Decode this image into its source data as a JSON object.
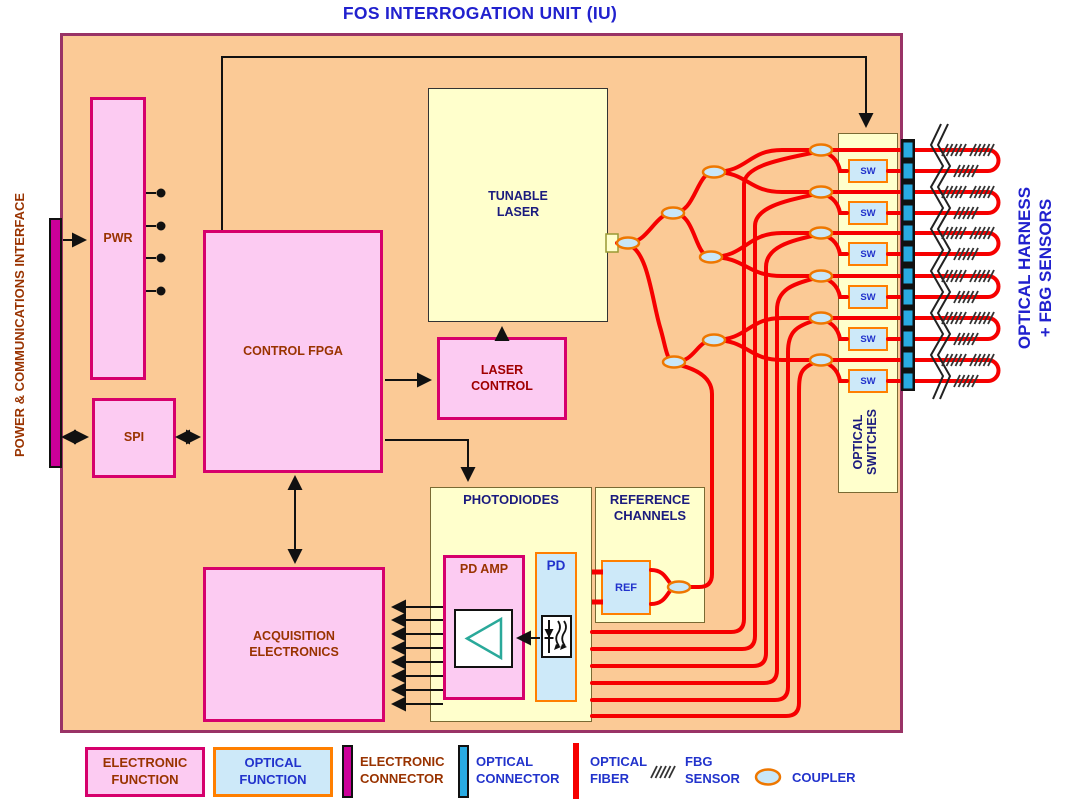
{
  "title": "FOS INTERROGATION UNIT (IU)",
  "side_labels": {
    "left": "POWER & COMMUNICATIONS INTERFACE",
    "right_line1": "OPTICAL HARNESS",
    "right_line2": "+ FBG SENSORS",
    "optical_switches": "OPTICAL SWITCHES"
  },
  "nodes": {
    "pwr": "PWR",
    "spi": "SPI",
    "control_fpga": "CONTROL FPGA",
    "tunable_laser": "TUNABLE LASER",
    "laser_control": "LASER CONTROL",
    "acquisition_electronics": "ACQUISITION ELECTRONICS",
    "photodiodes": "PHOTODIODES",
    "pd_amp": "PD AMP",
    "pd": "PD",
    "reference_channels": "REFERENCE CHANNELS",
    "ref": "REF"
  },
  "switches": [
    "SW",
    "SW",
    "SW",
    "SW",
    "SW",
    "SW"
  ],
  "legend": {
    "electronic_function": "ELECTRONIC FUNCTION",
    "optical_function": "OPTICAL FUNCTION",
    "electronic_connector": "ELECTRONIC CONNECTOR",
    "optical_connector": "OPTICAL CONNECTOR",
    "optical_fiber": "OPTICAL FIBER",
    "fbg_sensor": "FBG SENSOR",
    "coupler": "COUPLER"
  },
  "colors": {
    "unit_fill": "#FBCA96",
    "unit_border": "#993366",
    "electronic_fill": "#FCCBF2",
    "electronic_border": "#D6006C",
    "electronic_text": "#993300",
    "optical_fill": "#CDE9F9",
    "optical_border": "#FF7F00",
    "optical_text": "#2233CC",
    "group_fill": "#FFFFCC",
    "group_border": "#7A6A33",
    "navy_text": "#1B1B7E",
    "laser_text": "#A00000",
    "fiber_red": "#F60000",
    "connector_magenta": "#CC0099",
    "connector_blue": "#29ABE2",
    "wire_black": "#111111",
    "title_blue": "#2121CE",
    "coupler_fill": "#C9E7F8",
    "coupler_border": "#EE7700"
  }
}
